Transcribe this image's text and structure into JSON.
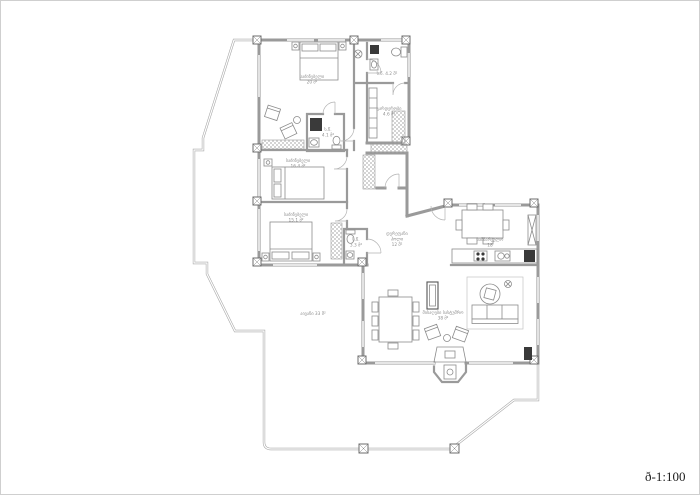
{
  "page": {
    "scale_label": "ð-1:100"
  },
  "colors": {
    "wall": "#9a9a9a",
    "pier": "#6e6e6e",
    "furniture": "#8c8c8c",
    "dark_fixture": "#3a3a3a",
    "terrace_line": "#a8a8a8",
    "label_text": "#8f8f8f",
    "scale_text": "#1c1c1c",
    "background": "#ffffff"
  },
  "rooms": {
    "bedroom_top": {
      "name": "საძინებელი",
      "area": "20 მ²"
    },
    "bathroom_top": {
      "name": "ს.წ. 4.2 მ²"
    },
    "wardrobe": {
      "name": "გარდერობი",
      "area": "4.6 მ²"
    },
    "bathroom_mid": {
      "name": "ს.წ.",
      "area": "4.1 მ²"
    },
    "bedroom_mid": {
      "name": "საძინებელი",
      "area": "16.4 მ²"
    },
    "bedroom_low": {
      "name": "საძინებელი",
      "area": "15.1 მ²"
    },
    "wc": {
      "name": "ს.წ.",
      "area": "3.3 მ²"
    },
    "hall": {
      "line1": "დერეფანი",
      "line2": "ჰოლი",
      "line3": "12 მ²"
    },
    "kitchen": {
      "name": "სამზარეულო",
      "area": "18"
    },
    "living": {
      "name": "მისაღები სასტუმრო",
      "area": "38 მ²"
    },
    "terrace": {
      "name": "აივანი 33 მ²"
    }
  }
}
